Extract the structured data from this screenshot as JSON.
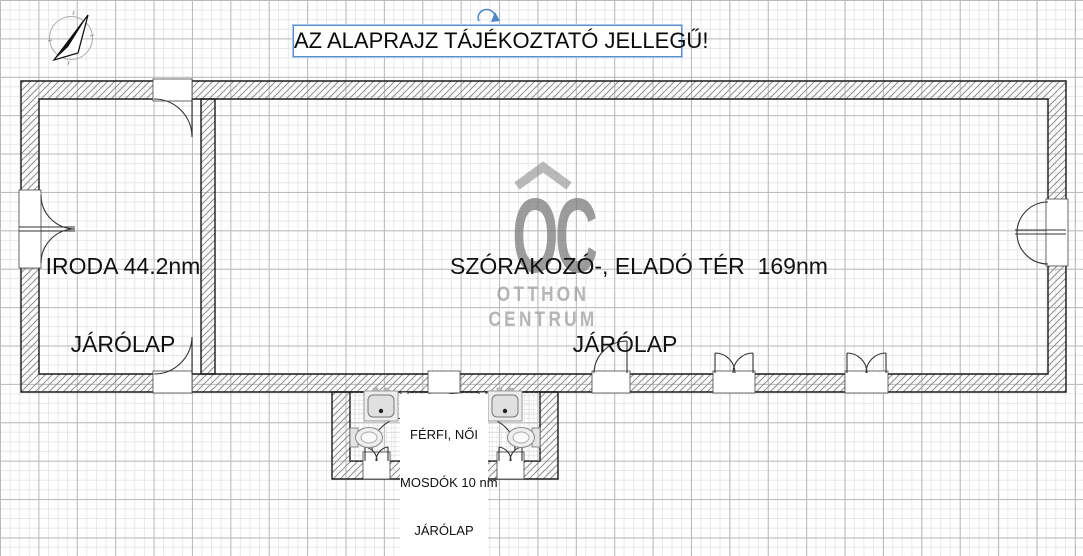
{
  "title": {
    "text": "AZ ALAPRAJZ TÁJÉKOZTATÓ JELLEGŰ!"
  },
  "rooms": {
    "iroda": {
      "name": "IRODA 44.2nm",
      "flooring": "JÁRÓLAP"
    },
    "main": {
      "name": "SZÓRAKOZÓ-, ELADÓ TÉR  169nm",
      "flooring": "JÁRÓLAP"
    },
    "restroom": {
      "line1": "FÉRFI, NŐI",
      "line2": "MOSDÓK 10 nm",
      "line3": "JÁRÓLAP"
    }
  },
  "watermark": {
    "logo": "OC",
    "line1": "OTTHON",
    "line2": "CENTRUM"
  },
  "icons": {
    "compass": "north-arrow-compass",
    "rotation_handle": "rotate-arrow",
    "fixtures": [
      "sink",
      "toilet",
      "door-swing-arc"
    ]
  },
  "colors": {
    "selection_blue": "#5b8fc9",
    "watermark_gray": "#9c9c9c",
    "wall_line": "#1a1a1a",
    "hatch_gray": "#8f8f8f",
    "grid_minor": "#e7e7e7",
    "grid_major": "#b7bbbb"
  }
}
